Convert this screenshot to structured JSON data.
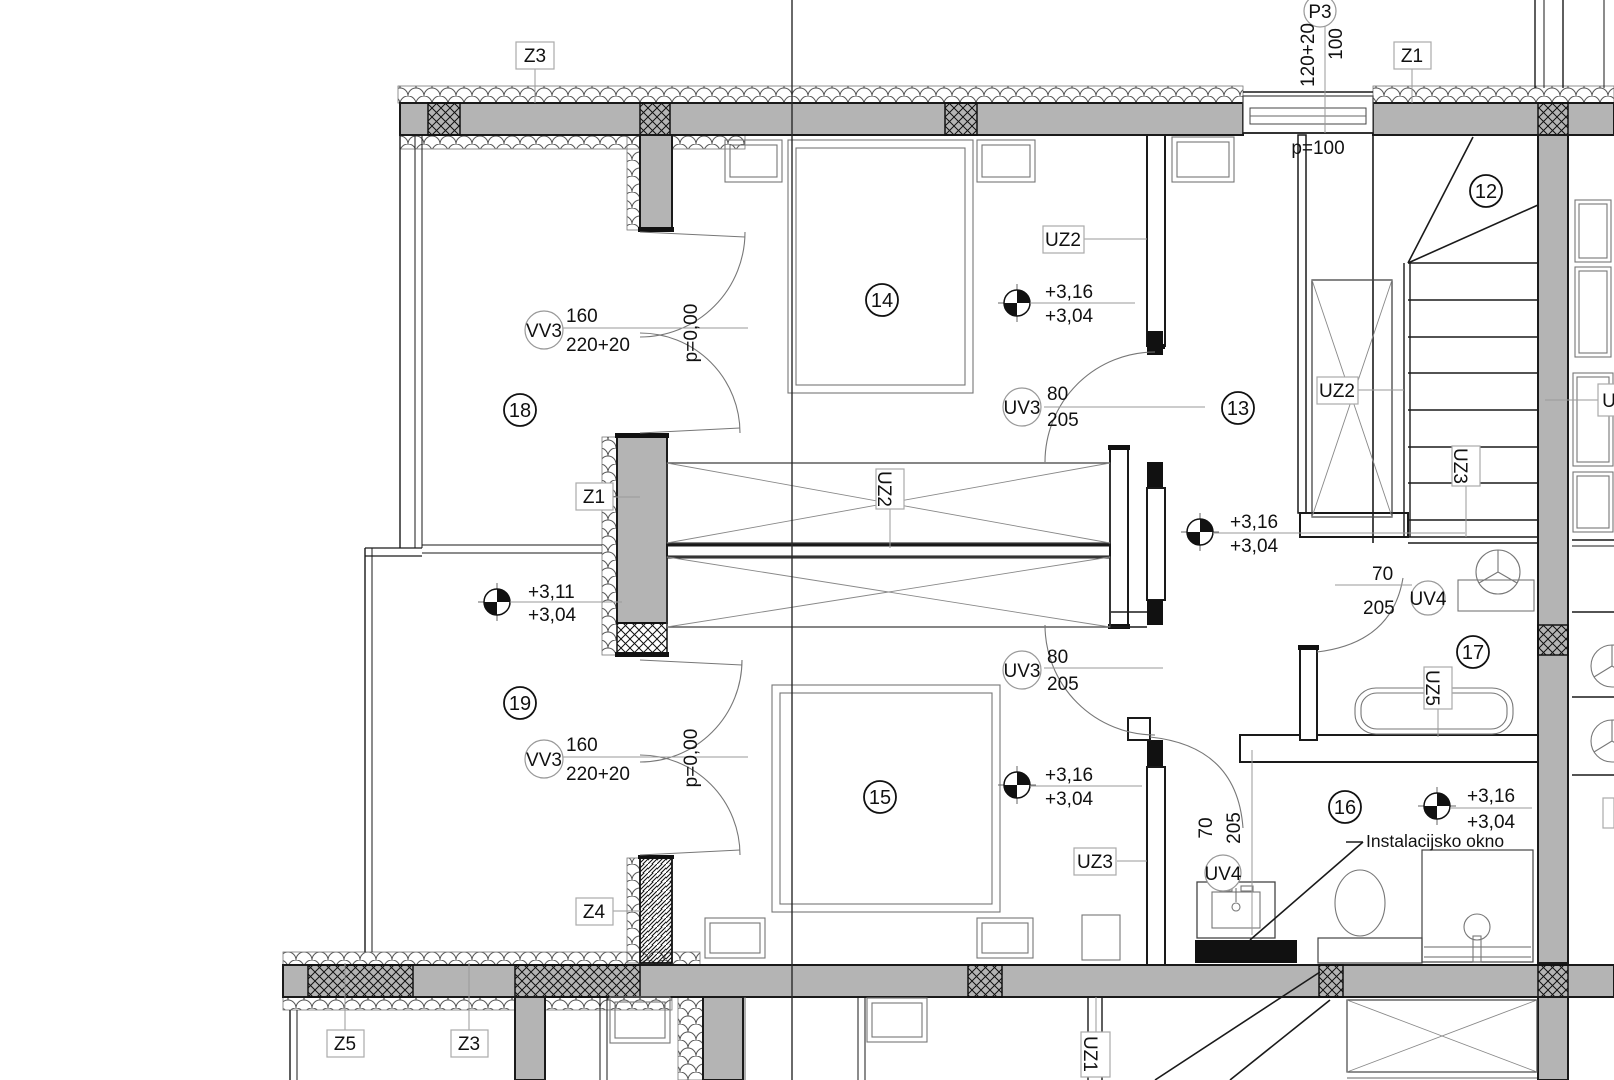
{
  "colors": {
    "wall_gray": "#b4b4b4",
    "line": "#1a1a1a",
    "leader": "#999999"
  },
  "rooms": {
    "r12": "12",
    "r13": "13",
    "r14": "14",
    "r15": "15",
    "r16": "16",
    "r17": "17",
    "r18": "18",
    "r19": "19"
  },
  "tags": {
    "z3_top": "Z3",
    "z1_top": "Z1",
    "z1_left": "Z1",
    "z4": "Z4",
    "z5_bot": "Z5",
    "z3_bot": "Z3",
    "uz1": "UZ1",
    "uz2_top": "UZ2",
    "uz2_mid": "UZ2",
    "uz2_stair": "UZ2",
    "uz3_stair": "UZ3",
    "uz3_bot": "UZ3",
    "uz5": "UZ5",
    "u_clip": "U"
  },
  "doors": {
    "vv3_top": {
      "tag": "VV3",
      "w": "160",
      "h": "220+20",
      "p": "p=0,00"
    },
    "vv3_bot": {
      "tag": "VV3",
      "w": "160",
      "h": "220+20",
      "p": "p=0,00"
    },
    "uv3_top": {
      "tag": "UV3",
      "w": "80",
      "h": "205"
    },
    "uv3_bot": {
      "tag": "UV3",
      "w": "80",
      "h": "205"
    },
    "uv4_17": {
      "tag": "UV4",
      "w": "70",
      "h": "205"
    },
    "uv4_16": {
      "tag": "UV4",
      "w": "70",
      "h": "205"
    }
  },
  "window": {
    "tag": "P3",
    "w": "100",
    "h": "120+20",
    "parapet": "p=100"
  },
  "levels": {
    "m14": {
      "a": "+3,16",
      "b": "+3,04"
    },
    "m13": {
      "a": "+3,16",
      "b": "+3,04"
    },
    "m18": {
      "a": "+3,11",
      "b": "+3,04"
    },
    "m15": {
      "a": "+3,16",
      "b": "+3,04"
    },
    "m16": {
      "a": "+3,16",
      "b": "+3,04"
    }
  },
  "notes": {
    "install_window": "Instalacijsko okno"
  }
}
